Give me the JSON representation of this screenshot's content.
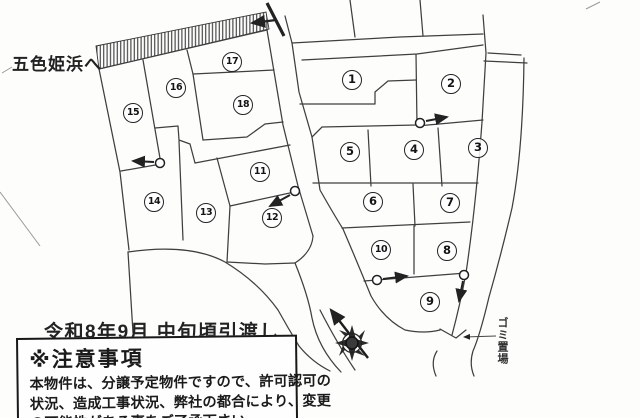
{
  "map": {
    "destination_label": "五色姫浜へ",
    "handover_text": "令和8年9月 中旬頃引渡し",
    "garbage_area_label": "ゴミ置場",
    "lots": [
      {
        "number": "1",
        "x": 352,
        "y": 80
      },
      {
        "number": "2",
        "x": 451,
        "y": 84
      },
      {
        "number": "3",
        "x": 478,
        "y": 148
      },
      {
        "number": "4",
        "x": 414,
        "y": 150
      },
      {
        "number": "5",
        "x": 350,
        "y": 152
      },
      {
        "number": "6",
        "x": 373,
        "y": 202
      },
      {
        "number": "7",
        "x": 450,
        "y": 203
      },
      {
        "number": "8",
        "x": 447,
        "y": 251
      },
      {
        "number": "9",
        "x": 430,
        "y": 302
      },
      {
        "number": "10",
        "x": 381,
        "y": 250
      },
      {
        "number": "11",
        "x": 260,
        "y": 172
      },
      {
        "number": "12",
        "x": 272,
        "y": 218
      },
      {
        "number": "13",
        "x": 206,
        "y": 213
      },
      {
        "number": "14",
        "x": 154,
        "y": 202
      },
      {
        "number": "15",
        "x": 133,
        "y": 113
      },
      {
        "number": "16",
        "x": 176,
        "y": 88
      },
      {
        "number": "17",
        "x": 232,
        "y": 62
      },
      {
        "number": "18",
        "x": 243,
        "y": 105
      }
    ]
  },
  "notice": {
    "title": "※注意事項",
    "body_lines": [
      "本物件は、分譲予定物件ですので、許可認可の",
      "状況、造成工事状況、弊社の都合により、変更",
      "の可能性がある事をご了承下さい。"
    ]
  },
  "colors": {
    "line": "#3f3f3f",
    "dark": "#1b1b1b"
  }
}
